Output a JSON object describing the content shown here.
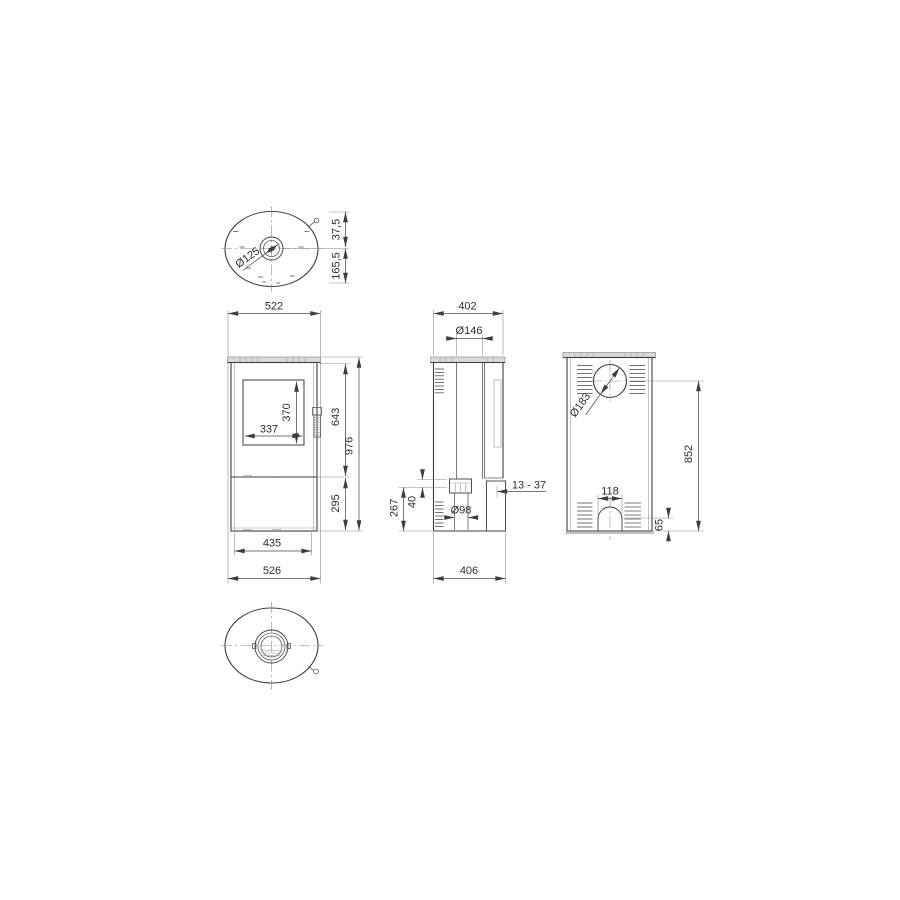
{
  "drawing": {
    "type": "technical-multiview-drawing",
    "subject": "free-standing stove dimensional drawing",
    "colors": {
      "background": "#ffffff",
      "line": "#3d3d3d",
      "plate_fill": "#d9d9d9"
    },
    "dims": {
      "top": {
        "flue": "Ø125",
        "d1": "37,5",
        "d2": "165,5"
      },
      "front": {
        "w_top": "522",
        "glass_w": "337",
        "glass_h": "370",
        "firebox_h": "643",
        "total_h": "976",
        "lower_h": "295",
        "base_w": "435",
        "w_bottom": "526"
      },
      "side": {
        "d_top": "402",
        "flue": "Ø146",
        "inlet_h": "267",
        "flange_h": "40",
        "inlet_d": "Ø98",
        "gap": "13 - 37",
        "d_bottom": "406"
      },
      "back": {
        "flue": "Ø183",
        "flue_h": "852",
        "arch_w": "118",
        "arch_h": "65"
      }
    }
  }
}
